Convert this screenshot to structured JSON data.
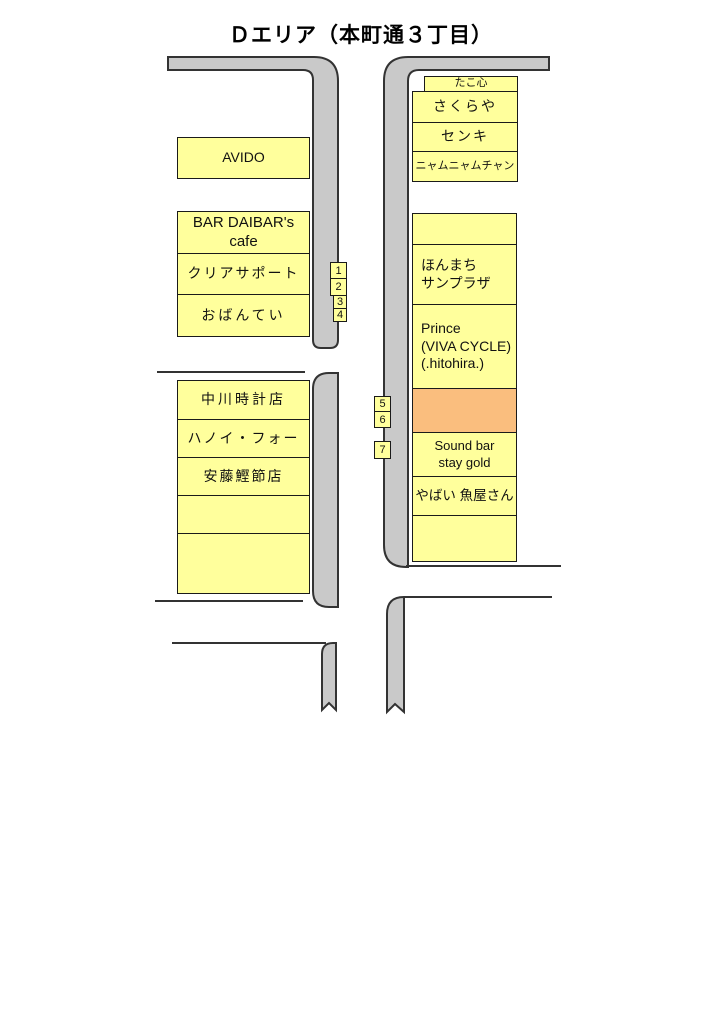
{
  "title": "Ｄエリア（本町通３丁目）",
  "colors": {
    "box_fill": "#FFFF9C",
    "highlight_fill": "#FABE7E",
    "road_fill": "#C9C9C9",
    "outline": "#1A1A1A"
  },
  "blocks": {
    "upper_left": {
      "stores": [
        {
          "label": "AVIDO"
        },
        {
          "label": "BAR DAIBAR's cafe"
        },
        {
          "label": "クリアサポート"
        },
        {
          "label": "おばんてい"
        }
      ]
    },
    "lower_left": {
      "stores": [
        {
          "label": "中川時計店"
        },
        {
          "label": "ハノイ・フォー"
        },
        {
          "label": "安藤鰹節店"
        },
        {
          "label": ""
        },
        {
          "label": ""
        }
      ]
    },
    "upper_right": {
      "stores": [
        {
          "label": "たこ心"
        },
        {
          "label": "さくらや"
        },
        {
          "label": "センキ"
        },
        {
          "label": "ニャムニャムチャン"
        }
      ]
    },
    "main_right": {
      "empty_top": "",
      "honmachi": {
        "line1": "ほんまち",
        "line2": "サンプラザ"
      },
      "prince": {
        "line1": "Prince",
        "line2": "(VIVA CYCLE)",
        "line3": "(.hitohira.)"
      },
      "highlight": "",
      "soundbar": {
        "line1": "Sound bar",
        "line2": "stay gold"
      },
      "yabai": "やばい 魚屋さん",
      "empty_bottom": ""
    }
  },
  "markers": {
    "m1": "1",
    "m2": "2",
    "m3": "3",
    "m4": "4",
    "m5": "5",
    "m6": "6",
    "m7": "7"
  }
}
